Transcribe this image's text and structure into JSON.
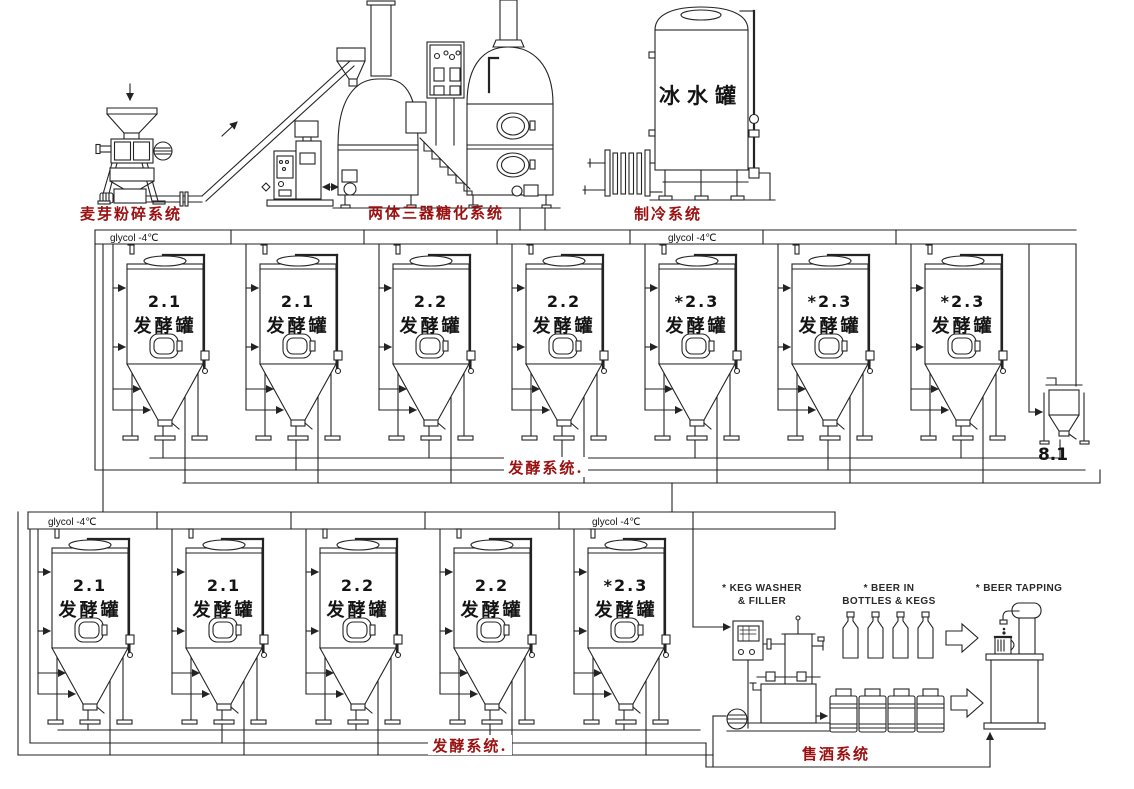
{
  "colors": {
    "line": "#232323",
    "red_label": "#9b1111",
    "text": "#141414"
  },
  "malt_mill": {
    "caption": "麦芽粉碎系统"
  },
  "brewhouse": {
    "caption": "两体三器糖化系统"
  },
  "cooling": {
    "caption": "制冷系统"
  },
  "ice_water_tank": {
    "label": "冰水罐"
  },
  "fermentation_row1": {
    "glycol_label_left": "glycol -4℃",
    "glycol_label_right": "glycol -4℃",
    "caption": "发酵系统.",
    "tank_name": "发酵罐",
    "tanks": [
      {
        "id": "2.1"
      },
      {
        "id": "2.1"
      },
      {
        "id": "2.2"
      },
      {
        "id": "2.2"
      },
      {
        "id": "*2.3"
      },
      {
        "id": "*2.3"
      },
      {
        "id": "*2.3"
      }
    ]
  },
  "yeast_tank": {
    "label": "8.1"
  },
  "fermentation_row2": {
    "glycol_label_left": "glycol -4℃",
    "glycol_label_right": "glycol -4℃",
    "caption": "发酵系统.",
    "tank_name": "发酵罐",
    "tanks": [
      {
        "id": "2.1"
      },
      {
        "id": "2.1"
      },
      {
        "id": "2.2"
      },
      {
        "id": "2.2"
      },
      {
        "id": "*2.3"
      }
    ]
  },
  "sales": {
    "caption": "售酒系统",
    "keg_washer_line1": "* KEG WASHER",
    "keg_washer_line2": "& FILLER",
    "beer_in_line1": "* BEER IN",
    "beer_in_line2": "BOTTLES & KEGS",
    "tapping_label": "* BEER TAPPING"
  }
}
